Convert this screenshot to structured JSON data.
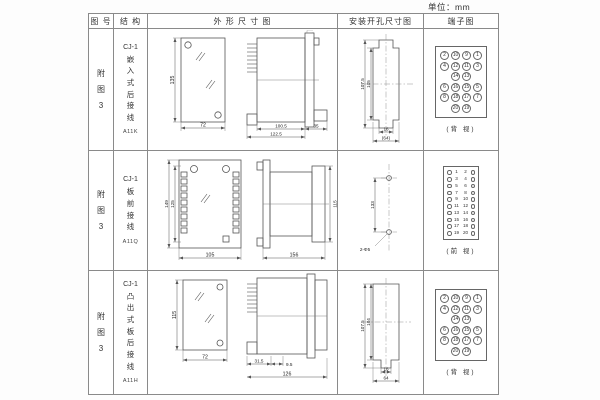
{
  "unit_label": "单位：mm",
  "header": {
    "fig": "图 号",
    "structure": "结 构",
    "outline": "外 形 尺 寸 图",
    "mounting": "安装开孔尺寸图",
    "terminal": "端子图"
  },
  "rows": [
    {
      "fig_no": "附图3",
      "series": "CJ-1",
      "structure_chars": "嵌入式后接线",
      "model": "A11K",
      "outline": {
        "front_h": "135",
        "front_w": "72",
        "side_d1": "100.5",
        "side_d2": "122.5",
        "side_d3": "35"
      },
      "mounting": {
        "outer_h": "107.5",
        "inner_h": "105",
        "slot_w": "16",
        "overall_w": "(64)"
      },
      "terminal": {
        "type": "grid",
        "rows": [
          [
            "2",
            "10",
            "9",
            "1"
          ],
          [
            "4",
            "12",
            "11",
            "3"
          ],
          [
            "",
            "14",
            "13",
            ""
          ],
          [
            "6",
            "16",
            "15",
            "5"
          ],
          [
            "8",
            "18",
            "17",
            "7"
          ],
          [
            "",
            "20",
            "19",
            ""
          ]
        ],
        "view": "(背 视)"
      }
    },
    {
      "fig_no": "附图3",
      "series": "CJ-1",
      "structure_chars": "板前接线",
      "model": "A11Q",
      "outline": {
        "front_h1": "149",
        "front_h2": "125",
        "front_w": "105",
        "side_len": "156",
        "side_h": "115"
      },
      "mounting": {
        "hole_dist": "133",
        "hole_label": "2-Φ5"
      },
      "terminal": {
        "type": "pairs",
        "rows": [
          [
            "1",
            "2"
          ],
          [
            "3",
            "4"
          ],
          [
            "5",
            "6"
          ],
          [
            "7",
            "8"
          ],
          [
            "9",
            "10"
          ],
          [
            "11",
            "12"
          ],
          [
            "13",
            "14"
          ],
          [
            "15",
            "16"
          ],
          [
            "17",
            "18"
          ],
          [
            "19",
            "20"
          ]
        ],
        "view": "(前 视)"
      }
    },
    {
      "fig_no": "附图3",
      "series": "CJ-1",
      "structure_chars": "凸出式板后接线",
      "model": "A11H",
      "outline": {
        "front_h": "115",
        "front_w": "72",
        "side_d1": "31.5",
        "side_d2": "9.5",
        "side_d3": "126"
      },
      "mounting": {
        "outer_h": "107.5",
        "inner_h": "104",
        "slot_w": "16",
        "overall_w": "64"
      },
      "terminal": {
        "type": "grid",
        "rows": [
          [
            "2",
            "10",
            "9",
            "1"
          ],
          [
            "4",
            "12",
            "11",
            "3"
          ],
          [
            "",
            "14",
            "13",
            ""
          ],
          [
            "6",
            "16",
            "15",
            "5"
          ],
          [
            "8",
            "18",
            "17",
            "7"
          ],
          [
            "",
            "20",
            "19",
            ""
          ]
        ],
        "view": "(背 视)"
      }
    }
  ]
}
